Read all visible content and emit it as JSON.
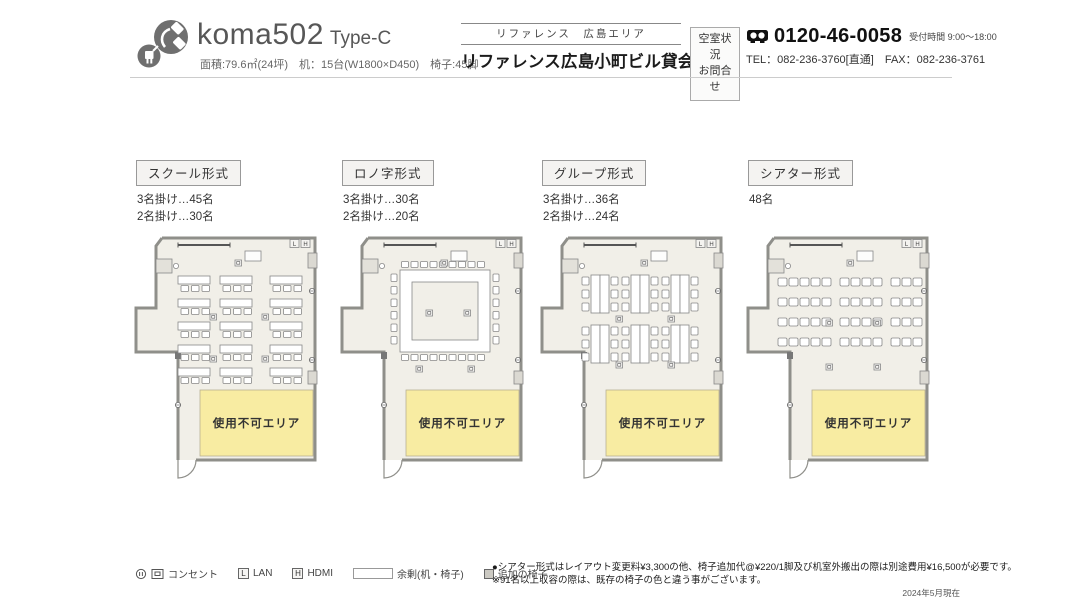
{
  "header": {
    "room_name": "koma502",
    "room_type": "Type-C",
    "specs": "面積:79.6㎡(24坪)　机：15台(W1800×D450)　椅子:45脚",
    "area_label": "リファレンス　広島エリア",
    "building_title": "リファレンス広島小町ビル貸会議室",
    "inquiry": {
      "line1": "空室状況",
      "line2": "お問合せ"
    },
    "phone": {
      "number": "0120-46-0058",
      "hours": "受付時間 9:00～18:00",
      "tel": "TEL：082-236-3760[直通]",
      "fax": "FAX：082-236-3761"
    }
  },
  "layouts": [
    {
      "id": "school",
      "label": "スクール形式",
      "capacity": [
        "3名掛け…45名",
        "2名掛け…30名"
      ]
    },
    {
      "id": "konoji",
      "label": "ロノ字形式",
      "capacity": [
        "3名掛け…30名",
        "2名掛け…20名"
      ]
    },
    {
      "id": "group",
      "label": "グループ形式",
      "capacity": [
        "3名掛け…36名",
        "2名掛け…24名"
      ]
    },
    {
      "id": "theater",
      "label": "シアター形式",
      "capacity": [
        "48名"
      ]
    }
  ],
  "floorplan": {
    "unusable_label": "使用不可エリア",
    "lan_label": "L",
    "hdmi_label": "H"
  },
  "legend": {
    "outlet": "コンセント",
    "lan": "LAN",
    "hdmi": "HDMI",
    "surplus": "余剰(机・椅子)",
    "extra_chair": "追加の椅子"
  },
  "footer": {
    "note1": "●シアター形式はレイアウト変更料¥3,300の他、椅子追加代@¥220/1脚及び机室外搬出の際は別途費用¥16,500が必要です。",
    "note2": "※91名以上収容の際は、既存の椅子の色と違う事がございます。",
    "as_of": "2024年5月現在"
  },
  "colors": {
    "room_fill": "#f1efe8",
    "wall": "#8f8f8a",
    "unusable_fill": "#f8eca2",
    "furniture_stroke": "#888888",
    "logo_gray": "#6f6f6f"
  }
}
